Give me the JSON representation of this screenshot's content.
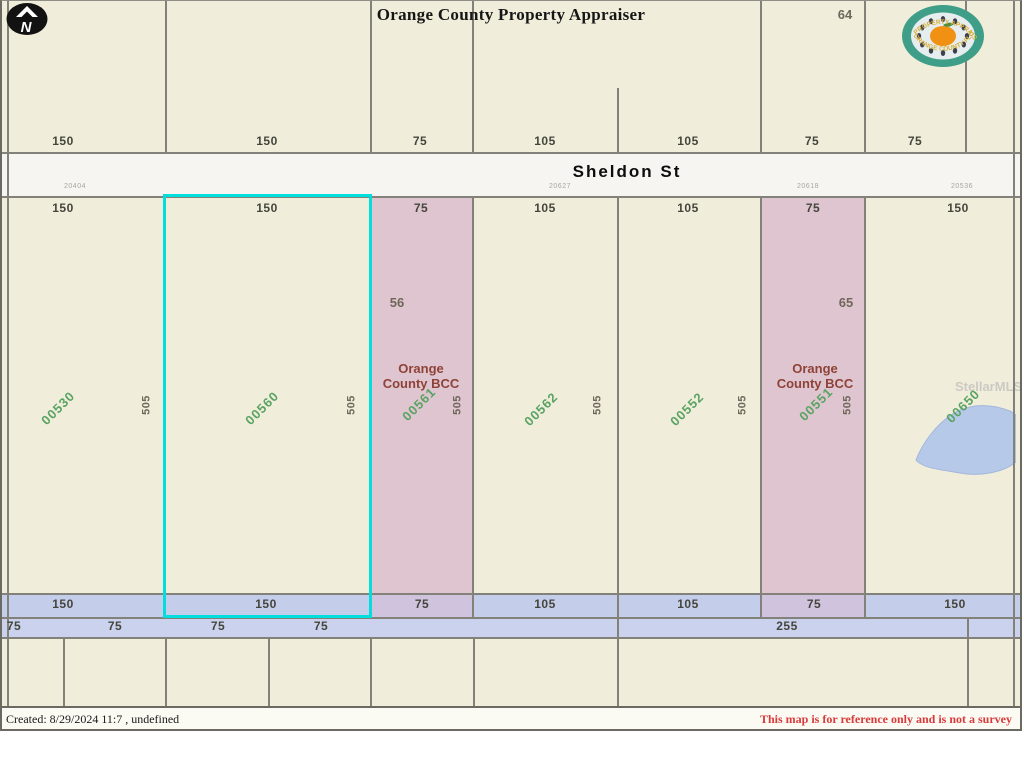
{
  "title": "Orange County Property Appraiser",
  "compass": {
    "letter": "N"
  },
  "seal": {
    "top_text": "PROPERTY APPRAISER",
    "bottom_text": "ORANGE COUNTY FLORIDA"
  },
  "street": {
    "name": "Sheldon St",
    "addresses": [
      {
        "text": "20404",
        "x": 75
      },
      {
        "text": "20627",
        "x": 560
      },
      {
        "text": "20618",
        "x": 808
      },
      {
        "text": "20536",
        "x": 962
      }
    ]
  },
  "top_strip": {
    "dims": [
      {
        "text": "150",
        "x": 63
      },
      {
        "text": "150",
        "x": 267
      },
      {
        "text": "75",
        "x": 420
      },
      {
        "text": "105",
        "x": 545
      },
      {
        "text": "105",
        "x": 688
      },
      {
        "text": "75",
        "x": 812
      },
      {
        "text": "75",
        "x": 915
      },
      {
        "text": "75",
        "x": 1028
      }
    ],
    "block_number": {
      "text": "64",
      "x": 845,
      "y": 8
    }
  },
  "main_strip": {
    "dims": [
      {
        "text": "150",
        "x": 63
      },
      {
        "text": "150",
        "x": 267
      },
      {
        "text": "75",
        "x": 421
      },
      {
        "text": "105",
        "x": 545
      },
      {
        "text": "105",
        "x": 688
      },
      {
        "text": "75",
        "x": 813
      },
      {
        "text": "150",
        "x": 958
      }
    ],
    "parcels": [
      {
        "id": "00530",
        "x": 7,
        "w": 158,
        "pink": false,
        "selected": false,
        "label_x": 58,
        "label_y": 408
      },
      {
        "id": "00560",
        "x": 165,
        "w": 205,
        "pink": false,
        "selected": true,
        "label_x": 262,
        "label_y": 408
      },
      {
        "id": "00561",
        "x": 370,
        "w": 102,
        "pink": true,
        "selected": false,
        "label_x": 419,
        "label_y": 404
      },
      {
        "id": "00562",
        "x": 472,
        "w": 145,
        "pink": false,
        "selected": false,
        "label_x": 541,
        "label_y": 409
      },
      {
        "id": "00552",
        "x": 617,
        "w": 143,
        "pink": false,
        "selected": false,
        "label_x": 687,
        "label_y": 409
      },
      {
        "id": "00551",
        "x": 760,
        "w": 104,
        "pink": true,
        "selected": false,
        "label_x": 816,
        "label_y": 404
      },
      {
        "id": "00650",
        "x": 864,
        "w": 149,
        "pink": false,
        "selected": false,
        "label_x": 963,
        "label_y": 406
      }
    ],
    "depth_labels": [
      {
        "text": "505",
        "x": 147
      },
      {
        "text": "505",
        "x": 352
      },
      {
        "text": "505",
        "x": 458
      },
      {
        "text": "505",
        "x": 598
      },
      {
        "text": "505",
        "x": 743
      },
      {
        "text": "505",
        "x": 848
      }
    ],
    "bcc_parcels": [
      {
        "owner_line1": "Orange",
        "owner_line2": "County BCC",
        "x": 421,
        "y": 361,
        "block_number": "56",
        "num_x": 397,
        "num_y": 296
      },
      {
        "owner_line1": "Orange",
        "owner_line2": "County BCC",
        "x": 815,
        "y": 361,
        "block_number": "65",
        "num_x": 846,
        "num_y": 296
      }
    ]
  },
  "road_band": {
    "row1": [
      {
        "text": "150",
        "x": 63
      },
      {
        "text": "150",
        "x": 266
      },
      {
        "text": "75",
        "x": 422
      },
      {
        "text": "105",
        "x": 545
      },
      {
        "text": "105",
        "x": 688
      },
      {
        "text": "75",
        "x": 814
      },
      {
        "text": "150",
        "x": 955
      }
    ],
    "row2": [
      {
        "text": "75",
        "x": 14
      },
      {
        "text": "75",
        "x": 115
      },
      {
        "text": "75",
        "x": 218
      },
      {
        "text": "75",
        "x": 321
      },
      {
        "text": "255",
        "x": 787
      }
    ]
  },
  "watermark": "StellarMLS",
  "footer": {
    "created": "Created: 8/29/2024 11:7  , undefined",
    "disclaimer": "This map is for reference only and is not a survey"
  },
  "colors": {
    "map_bg": "#f0eedb",
    "pink_parcel": "#dfc5cf",
    "pink_band_blend": "#cfc3de",
    "road_band1": "#c4cdea",
    "road_band2": "#cad2ed",
    "street_band": "#f6f5f1",
    "selection": "#00dede",
    "parcel_id_green": "#5aa363",
    "bcc_text": "#8e4238",
    "dim_text": "#45453c",
    "corner_text": "#6f675c",
    "disclaimer_red": "#d93a3a",
    "pond_fill": "#b7c9e8",
    "boundary_line": "#82827a"
  }
}
